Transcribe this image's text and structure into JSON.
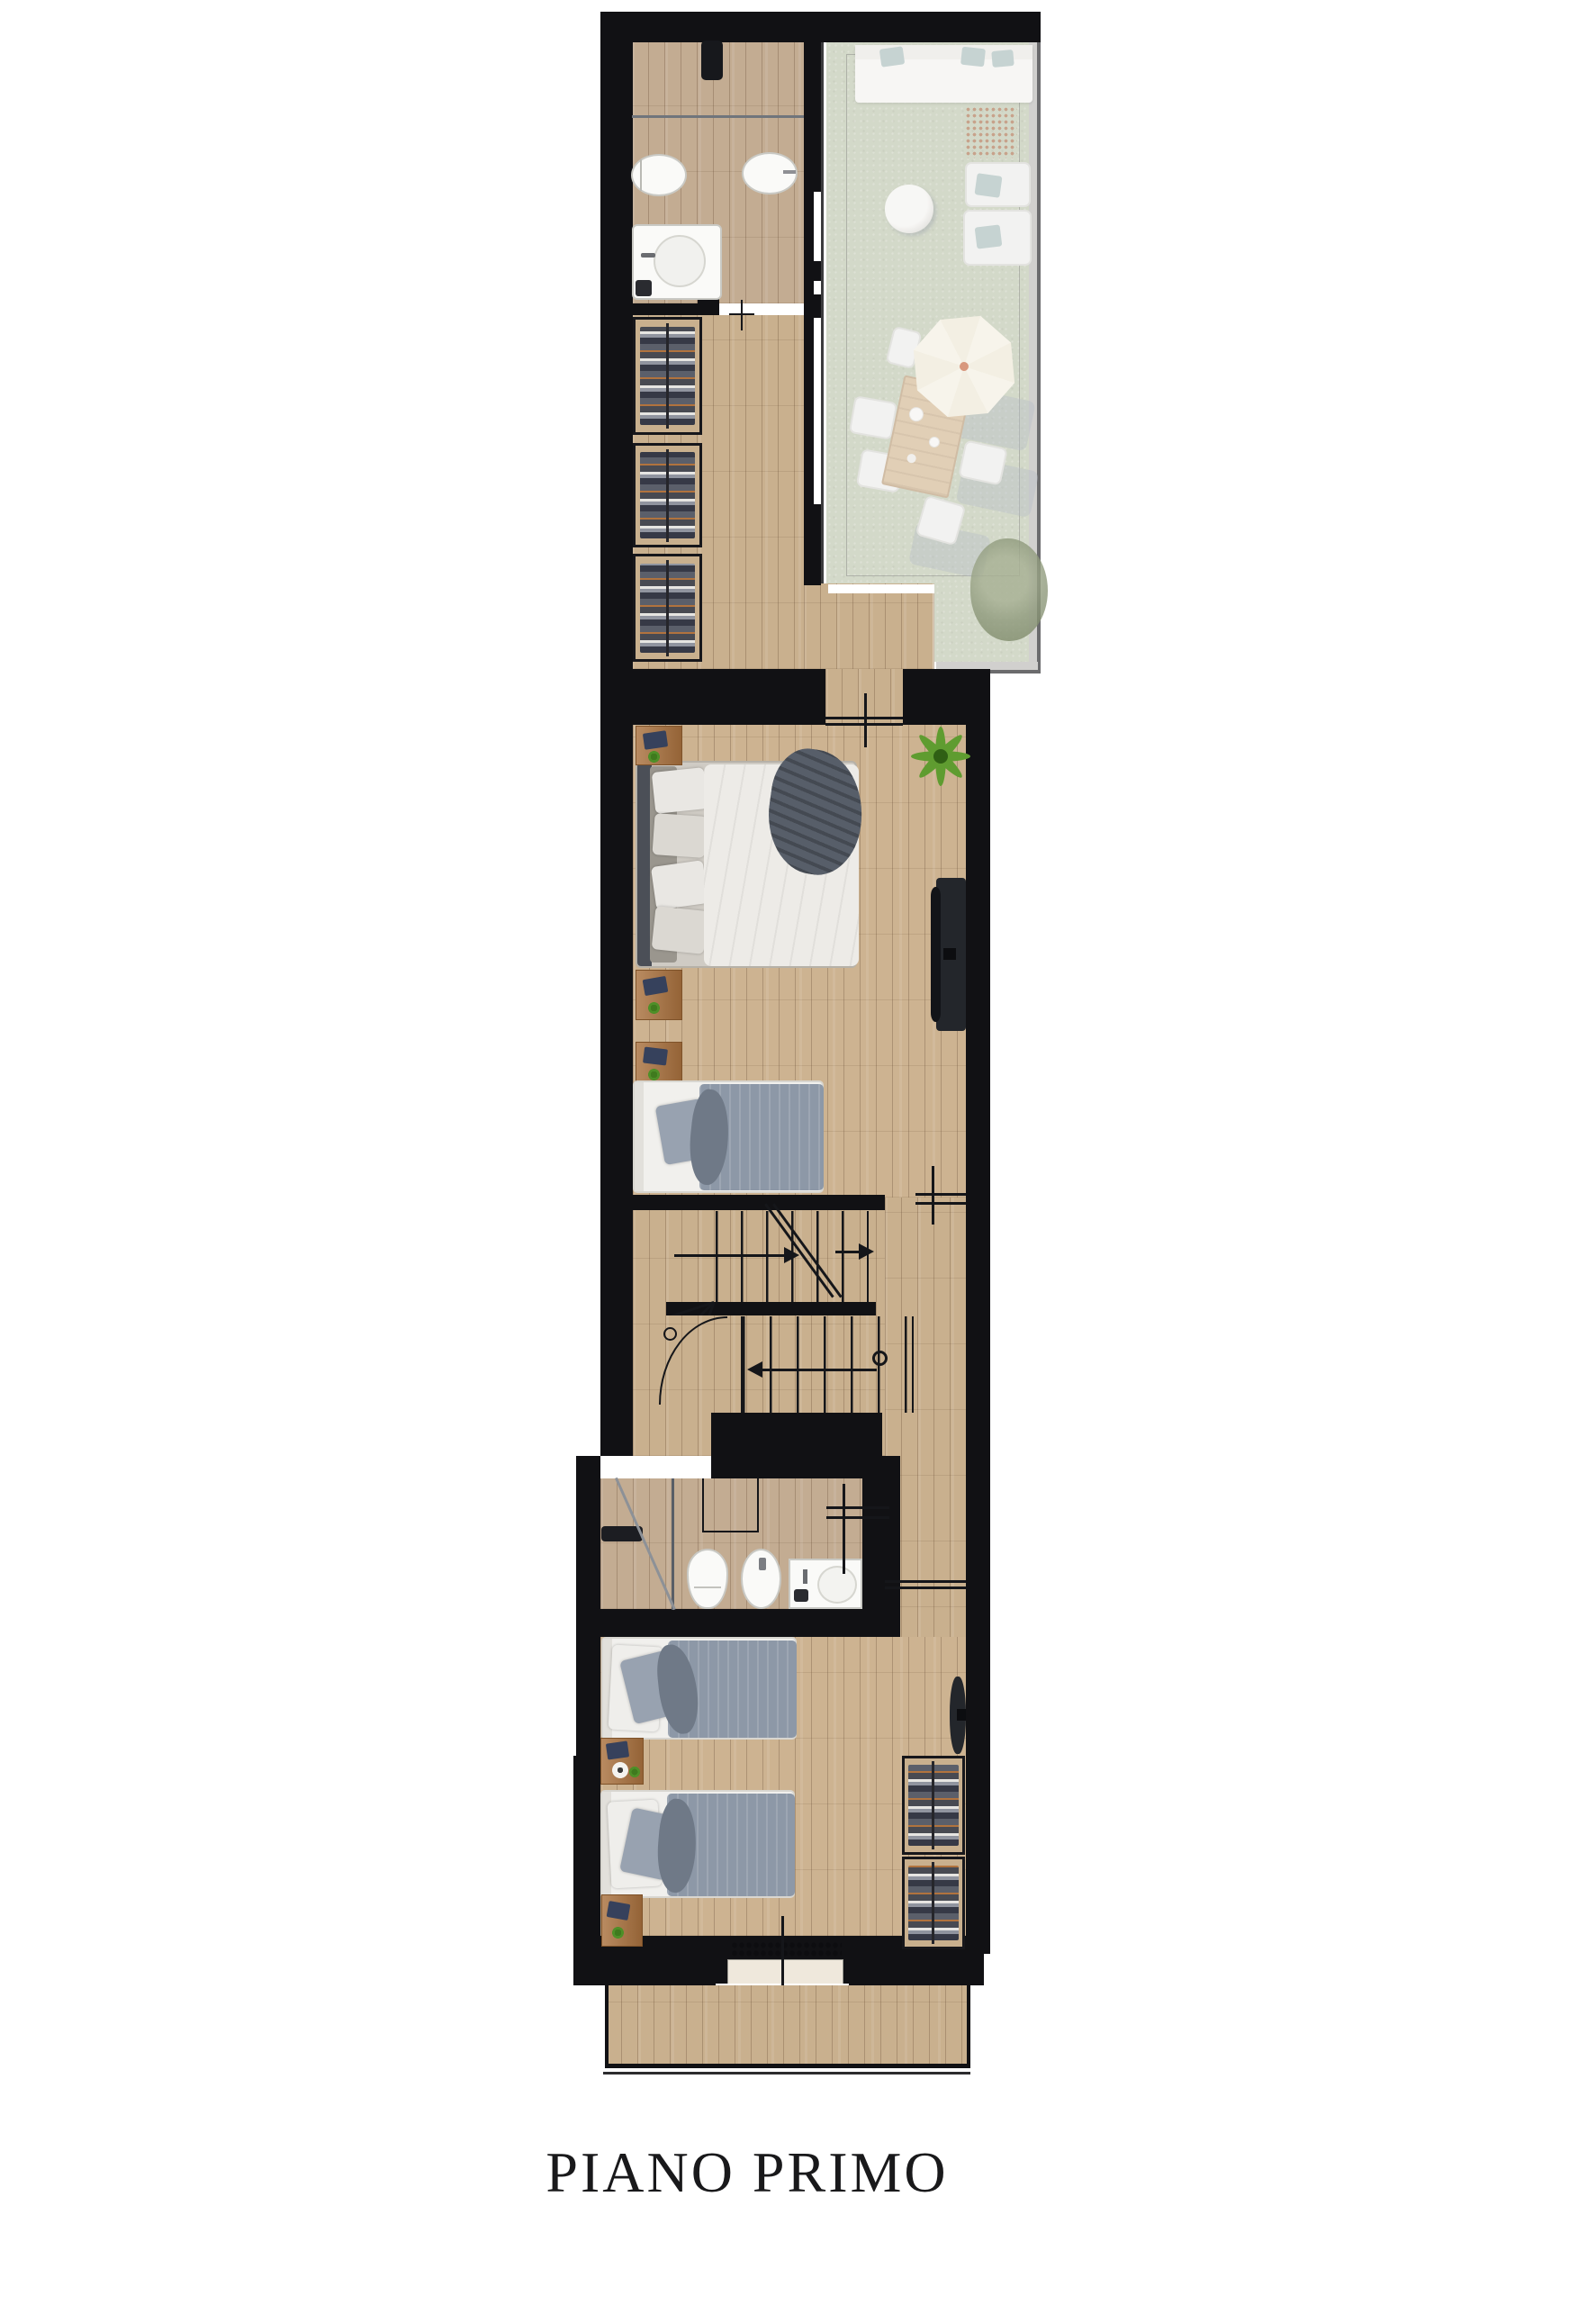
{
  "page": {
    "background": "#ffffff",
    "title": "PIANO PRIMO"
  },
  "palette": {
    "page_bg": "#ffffff",
    "wall": "#111114",
    "wood": "#c9b08e",
    "grass": "#b9c2a8",
    "rail_gray": "#b5b4b1",
    "glass_white": "#ffffff",
    "fixture": "#fafaf8",
    "duvet": "#edebe7",
    "blanket_gray": "#8d98a7",
    "pillow_gray": "#98a2b0",
    "throw_dark": "#575e69",
    "headboard": "#4b4f57",
    "nightstand": "#a9713e",
    "plant_green": "#4e8f28",
    "tv_dark": "#23262b",
    "table_wood": "#cfb28a",
    "umbrella": "#f3eedf",
    "chair_white": "#ebebe8",
    "sofa_white": "#f2f1ee",
    "teal_pillow": "#a3b8b6",
    "shadow": "#8a93a6",
    "mat_dots": "#a56a44",
    "bush_green": "#8e997b",
    "title_color": "#19191b"
  }
}
